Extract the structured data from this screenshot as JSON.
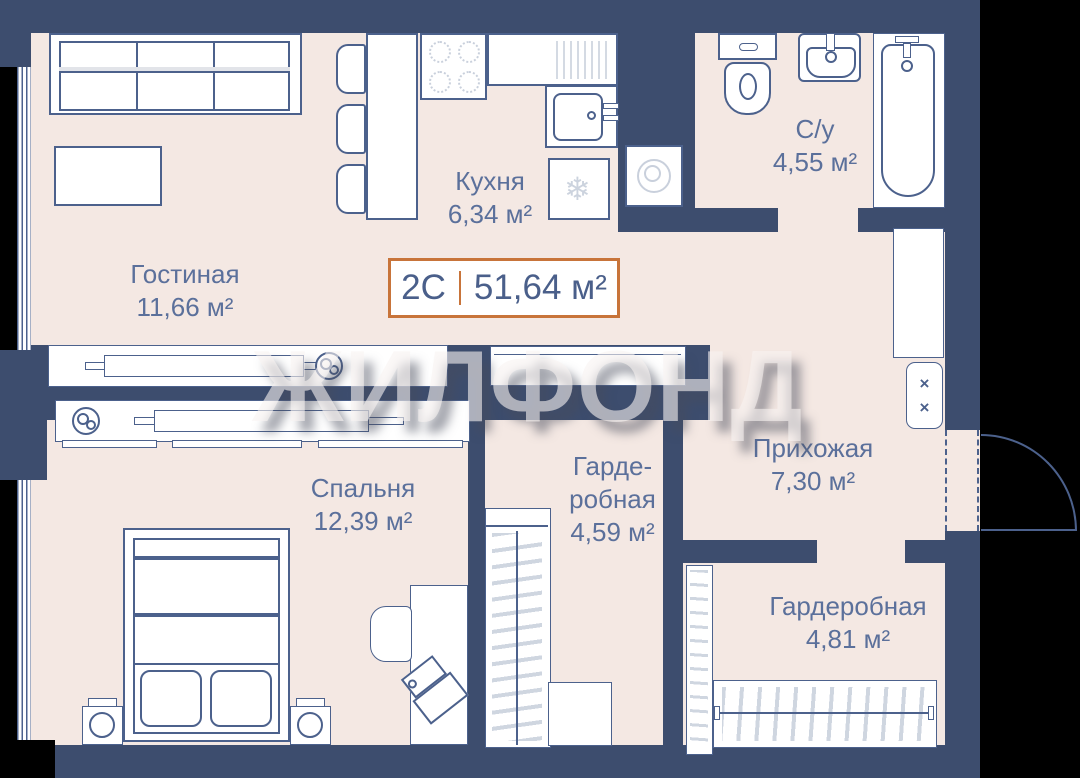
{
  "watermark": "ЖИЛФОНД",
  "badge": {
    "type": "2С",
    "area": "51,64 м²"
  },
  "rooms": {
    "living": {
      "name": "Гостиная",
      "area": "11,66 м²"
    },
    "kitchen": {
      "name": "Кухня",
      "area": "6,34 м²"
    },
    "bathroom": {
      "name": "С/у",
      "area": "4,55 м²"
    },
    "hallway": {
      "name": "Прихожая",
      "area": "7,30 м²"
    },
    "wardrobe_small": {
      "name_line1": "Гарде-",
      "name_line2": "робная",
      "area": "4,59 м²"
    },
    "bedroom": {
      "name": "Спальня",
      "area": "12,39 м²"
    },
    "wardrobe_large": {
      "name": "Гардеробная",
      "area": "4,81 м²"
    }
  },
  "icons": {
    "fridge_snowflake": "❄",
    "vent_cross": "×"
  },
  "colors": {
    "wall": "#3d4d6e",
    "floor": "#f4e8e3",
    "outline": "#4c618c",
    "text": "#5b709b",
    "accent_orange": "#c8743a",
    "furniture": "#ffffff",
    "detail_light": "#d3d9e3",
    "background": "#000000",
    "watermark": "rgba(248,243,241,0.60)"
  }
}
